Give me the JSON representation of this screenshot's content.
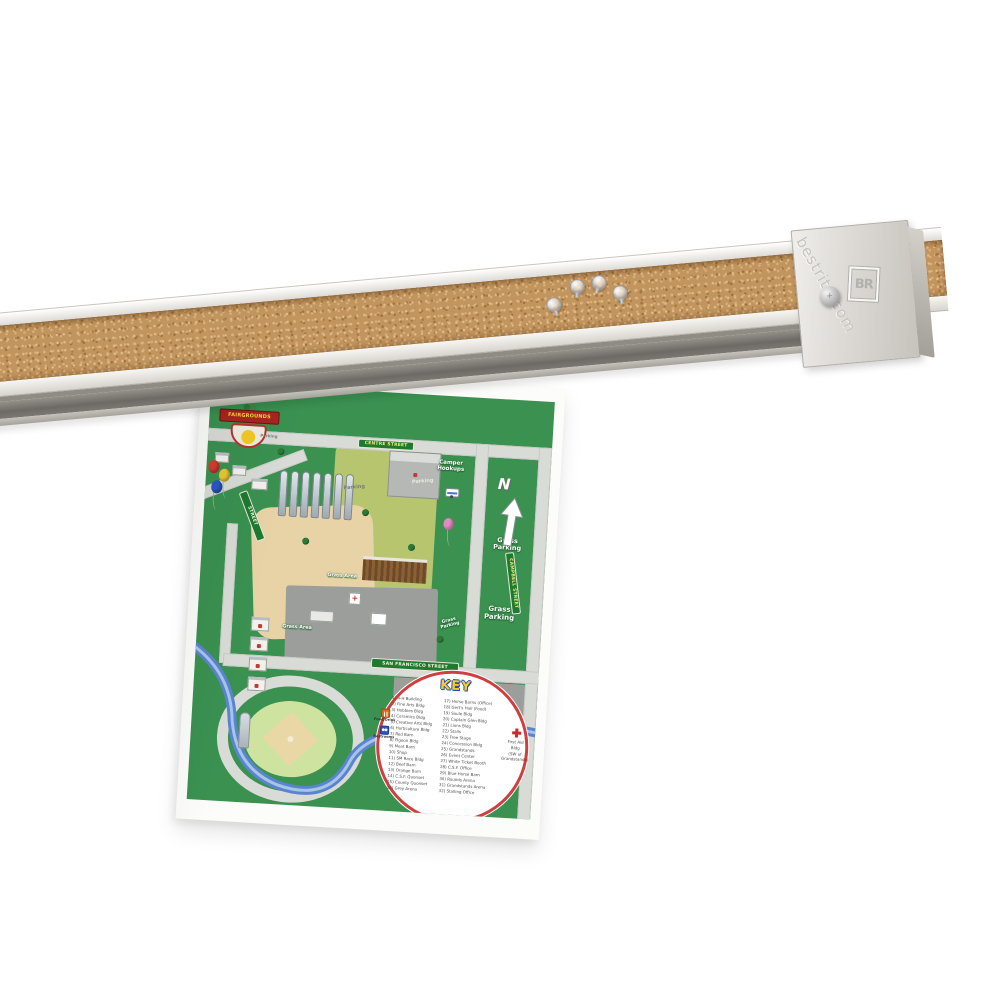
{
  "photo": {
    "description": "Wall-mounted cork strip bulletin bar with clear push pins, holding a printed fairgrounds map",
    "brand_text": "bestrite.com",
    "end_cap_logo": "BR",
    "push_pin_count": 4
  },
  "colors": {
    "cork": "#c2945e",
    "frame_white": "#efedea",
    "rail_gray": "#7c7872",
    "map_green": "#3a9150",
    "street_sign_green": "#1d7a2e",
    "key_ring_red": "#cf3f3f",
    "key_title_yellow": "#f5ce1e",
    "river_blue": "#5b84ce",
    "badge_red": "#a8251f",
    "paper_white": "#fcfcfa"
  },
  "map": {
    "badge": "FAIRGROUNDS",
    "north": "N",
    "streets": {
      "top": "CENTRE STREET",
      "right": "CAMPBELL STREET",
      "bottom": "SAN FRANCISCO STREET",
      "left": "STREET"
    },
    "labels": {
      "camper_hookups": "Camper Hookups",
      "grass_parking_1": "Grass Parking",
      "grass_parking_2": "Grass Parking",
      "grass_parking_small": "Grass Parking",
      "grass_area_1": "Grass Area",
      "grass_area_2": "Grass Area",
      "parking_1": "Parking",
      "parking_2": "Parking",
      "parking_3": "Parking"
    },
    "key": {
      "title": "KEY",
      "column1": [
        "1) 4-H Building",
        "2) Fine Arts Bldg",
        "3) Hobbies Bldg",
        "4) Ceramics Bldg",
        "5) Creative Arts Bldg",
        "6) Horticulture Bldg",
        "7) Red Barn",
        "8) Pigeon Bldg",
        "9) Meat Barn",
        "10) Shop",
        "11) SM Race Bldg",
        "12) Beef Barn",
        "13) Orange Barn",
        "14) C.S.F. Quonset",
        "15) County Quonset",
        "16) Grey Arena"
      ],
      "column2": [
        "17) Horse Barns (Office)",
        "18) Gert's Hall (Food)",
        "19) Soule Bldg",
        "20) Captain Glen Bldg",
        "21) Lions Bldg",
        "22) Stalls",
        "23) Free Stage",
        "24) Concession Bldg",
        "25) Grandstands",
        "26) Event Center",
        "27) White Ticket Booth",
        "28) C.S.F. Office",
        "29) Blue Horse Barn",
        "30) Rounds Arena",
        "31) Grandstands Arena",
        "32) Stalling Office"
      ],
      "first_aid_note": [
        "First Aid",
        "Bldg",
        "(SW of",
        "Grandstands)"
      ],
      "food_drink": "Food/Drink",
      "restrooms": "Restrooms"
    }
  }
}
